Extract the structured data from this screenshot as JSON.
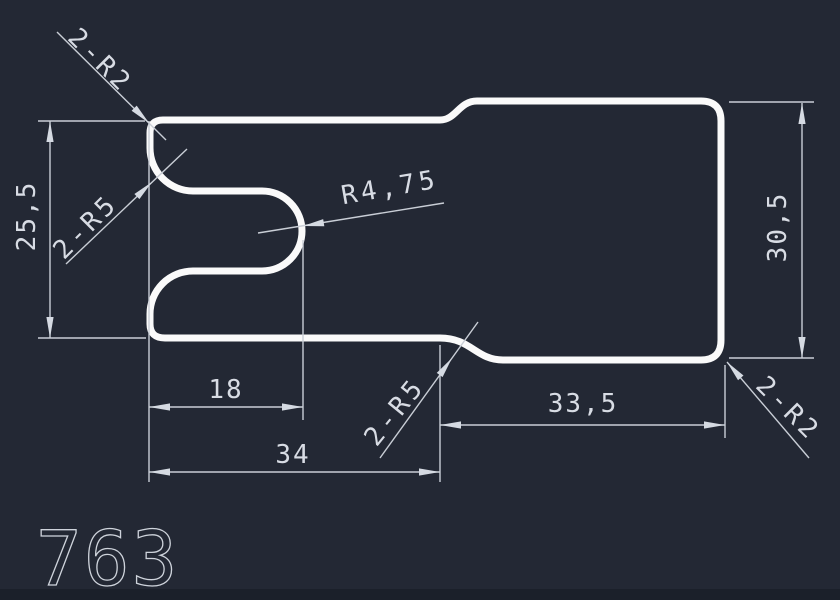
{
  "drawing": {
    "part_number": "763",
    "colors": {
      "background": "#232834",
      "bottom_strip": "#1b202a",
      "part_outline": "#fafafa",
      "dimension_lines": "#c9ced6",
      "dimension_text": "#d8dce4"
    },
    "dimensions": {
      "left_height": {
        "label": "25,5",
        "type": "linear-vertical",
        "measures": "height of left (slotted) section"
      },
      "right_height": {
        "label": "30,5",
        "type": "linear-vertical",
        "measures": "height of right section"
      },
      "slot_depth": {
        "label": "18",
        "type": "linear-horizontal",
        "measures": "slot depth from left face"
      },
      "left_width": {
        "label": "34",
        "type": "linear-horizontal",
        "measures": "width of left section"
      },
      "right_width": {
        "label": "33,5",
        "type": "linear-horizontal",
        "measures": "width of right section"
      },
      "slot_end_radius": {
        "label": "R4,75",
        "type": "radius-leader",
        "measures": "slot end cap radius"
      },
      "mouth_fillets": {
        "label": "2-R5",
        "type": "radius-leader",
        "measures": "slot mouth fillets, 2 places"
      },
      "step_fillets": {
        "label": "2-R5",
        "type": "radius-leader",
        "measures": "step transition fillets, 2 places"
      },
      "left_corner_radii": {
        "label": "2-R2",
        "type": "radius-leader",
        "measures": "left corner radii, 2 places"
      },
      "right_corner_radii": {
        "label": "2-R2",
        "type": "radius-leader",
        "measures": "right corner radii, 2 places"
      }
    }
  }
}
